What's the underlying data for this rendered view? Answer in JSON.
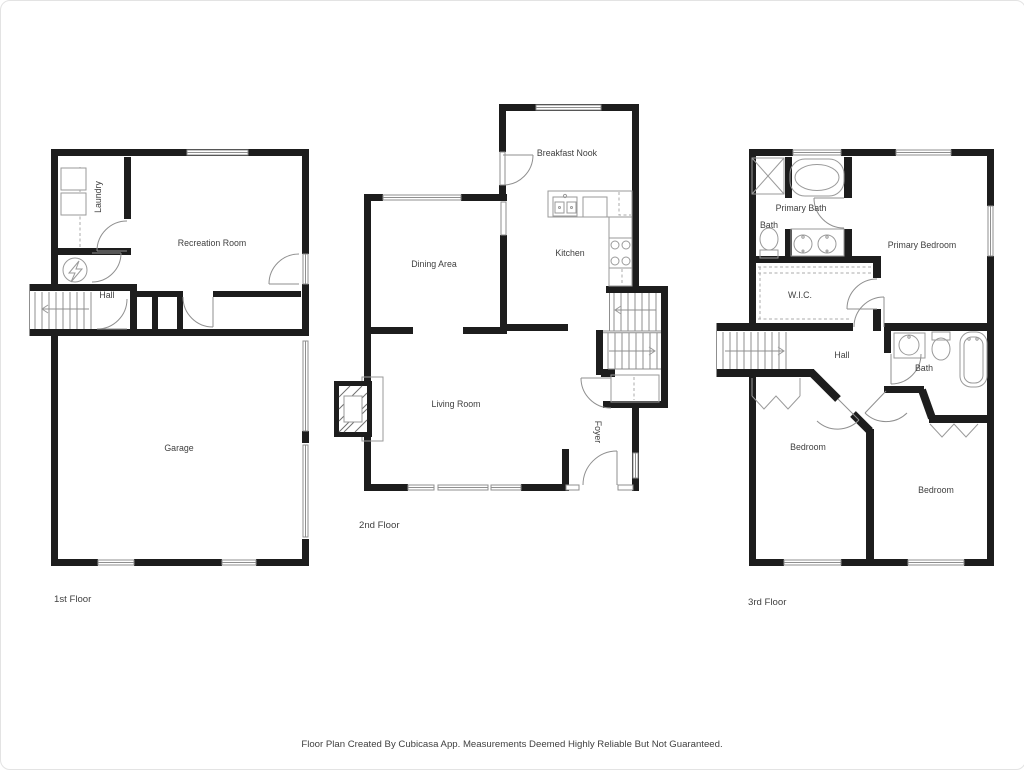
{
  "page": {
    "background": "#ffffff",
    "caption": "Floor Plan Created By Cubicasa App. Measurements Deemed Highly Reliable But Not Guaranteed."
  },
  "colors": {
    "wall": "#1d1d1d",
    "fixture": "#9a9a9a",
    "label": "#3f3f3f"
  },
  "floors": {
    "first": {
      "label": "1st Floor",
      "rooms": {
        "laundry": "Laundry",
        "recreation_room": "Recreation Room",
        "hall": "Hall",
        "garage": "Garage"
      }
    },
    "second": {
      "label": "2nd Floor",
      "rooms": {
        "breakfast_nook": "Breakfast Nook",
        "dining_area": "Dining Area",
        "kitchen": "Kitchen",
        "living_room": "Living Room",
        "foyer": "Foyer"
      }
    },
    "third": {
      "label": "3rd Floor",
      "rooms": {
        "bath_upper": "Bath",
        "primary_bath": "Primary Bath",
        "primary_bedroom": "Primary Bedroom",
        "wic": "W.I.C.",
        "hall": "Hall",
        "bath_lower": "Bath",
        "bedroom_left": "Bedroom",
        "bedroom_right": "Bedroom"
      }
    }
  }
}
